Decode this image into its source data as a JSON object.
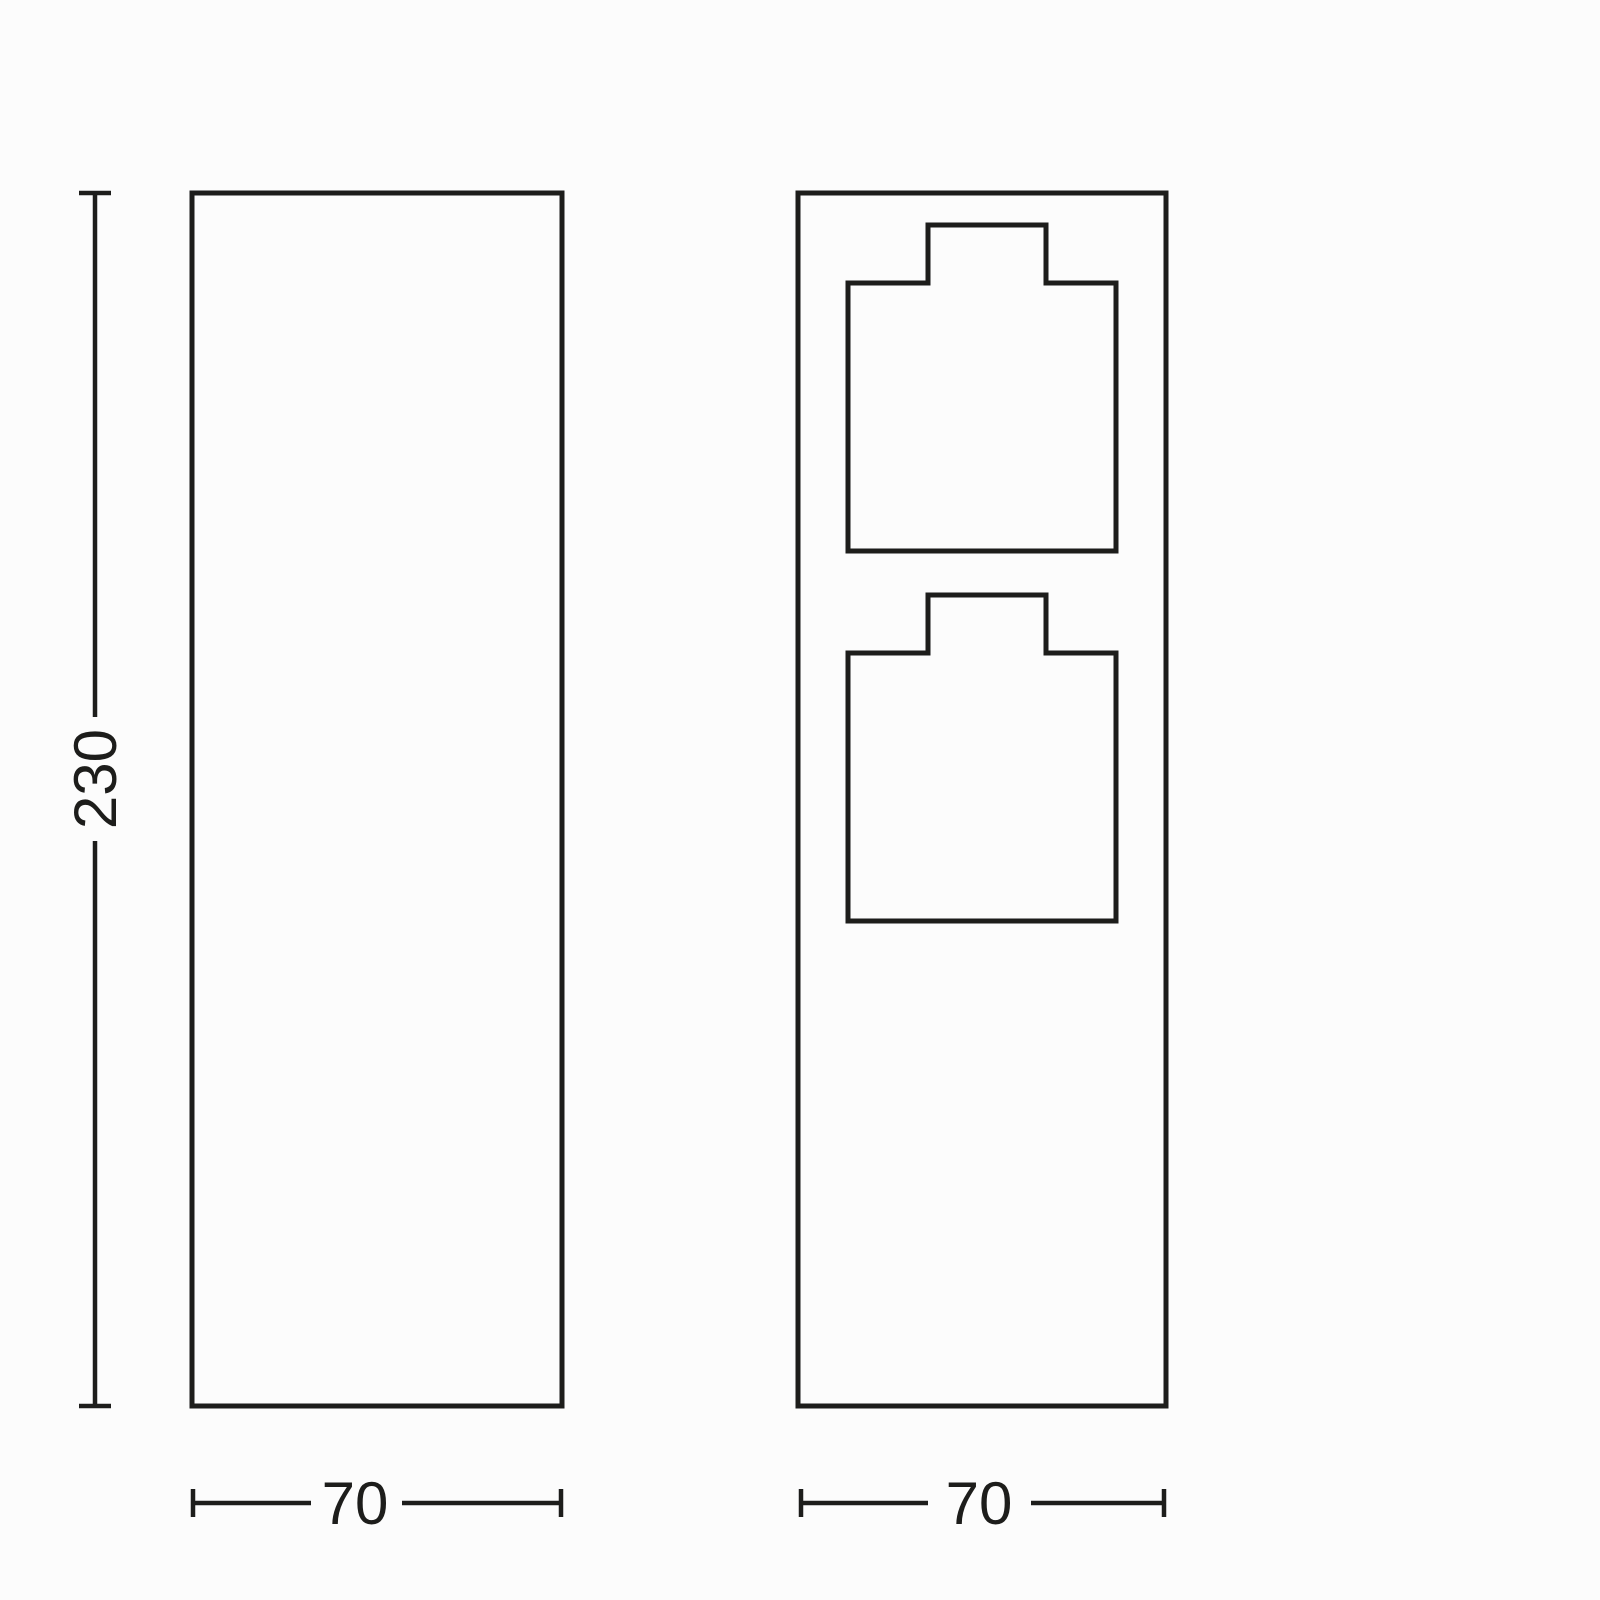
{
  "colors": {
    "line": "#1d1d1b",
    "background": "#fcfcfc",
    "text": "#1d1d1b"
  },
  "dimensions": {
    "height": "230",
    "left_view_width": "70",
    "right_view_width": "70"
  },
  "views": {
    "left": {
      "shape": "plain-column-outline"
    },
    "right": {
      "shape": "column-with-socket-covers",
      "socket_count": 2
    }
  }
}
